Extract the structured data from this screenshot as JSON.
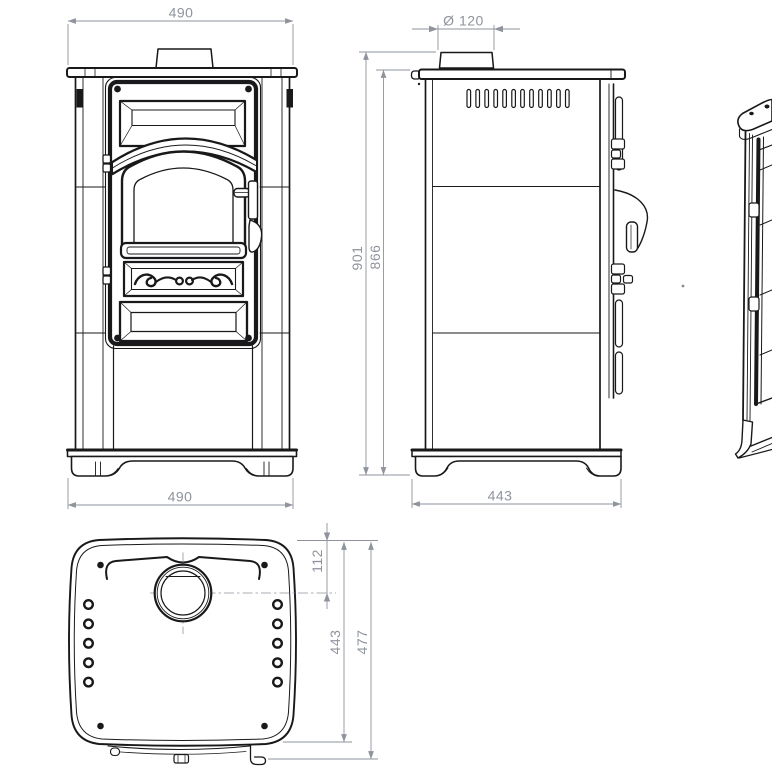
{
  "drawing_title": "stove-technical-drawing",
  "colors": {
    "line": "#19191b",
    "dimension": "#8e939c",
    "background": "#ffffff"
  },
  "views": {
    "front": {
      "label": "front-view",
      "dim_width_top": "490",
      "dim_width_bottom": "490"
    },
    "side": {
      "label": "side-view",
      "dim_flue_diameter": "Ø 120",
      "dim_height_overall": "901",
      "dim_height_to_top_plate": "866",
      "dim_depth_base": "443"
    },
    "top": {
      "label": "top-view",
      "dim_flue_center_from_back": "112",
      "dim_body_depth": "443",
      "dim_overall_depth": "477"
    },
    "perspective": {
      "label": "perspective-view"
    }
  }
}
